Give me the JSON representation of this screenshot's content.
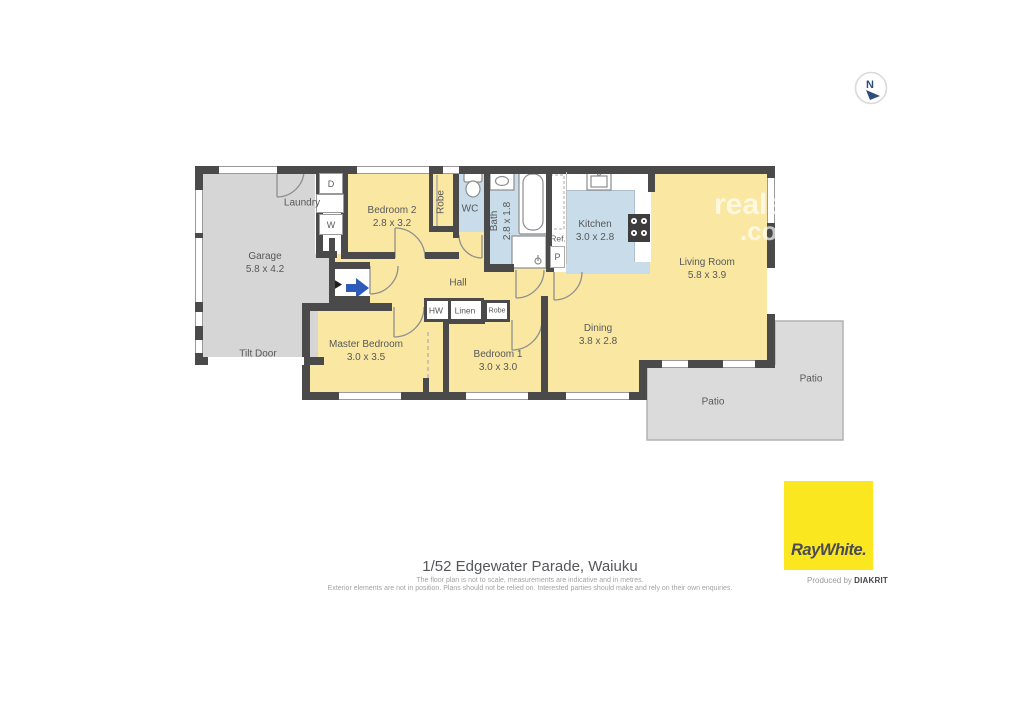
{
  "address": "1/52 Edgewater Parade, Waiuku",
  "disclaimer_line1": "The floor plan is not to scale, measurements are indicative and in metres.",
  "disclaimer_line2": "Exterior elements are not in position. Plans should not be relied on. Interested parties should make and rely on their own enquiries.",
  "compass": {
    "north_label": "N"
  },
  "watermark": {
    "line1": "realestate",
    "line2": ".com.au"
  },
  "branding": {
    "logo_text": "RayWhite.",
    "produced_by_prefix": "Produced by",
    "producer": "DIAKRIT",
    "logo_color": "#FBE71F"
  },
  "colors": {
    "room_yellow": "#FAE8A2",
    "wet_area_blue": "#C9DCE9",
    "garage_gray": "#D6D6D6",
    "patio_gray": "#DBDBDB",
    "wall": "#4A4A4A",
    "entry_arrow_blue": "#2E5BBA"
  },
  "rooms": {
    "garage": {
      "name": "Garage",
      "dims": "5.8 x 4.2"
    },
    "laundry": {
      "name": "Laundry"
    },
    "bedroom2": {
      "name": "Bedroom 2",
      "dims": "2.8 x 3.2"
    },
    "robe_bed2": {
      "name": "Robe"
    },
    "wc": {
      "name": "WC"
    },
    "bath": {
      "name": "Bath",
      "dims": "2.8 x 1.8"
    },
    "kitchen": {
      "name": "Kitchen",
      "dims": "3.0 x 2.8"
    },
    "living": {
      "name": "Living Room",
      "dims": "5.8 x 3.9"
    },
    "hall": {
      "name": "Hall"
    },
    "hw": {
      "name": "HW"
    },
    "linen": {
      "name": "Linen"
    },
    "robe_bed1": {
      "name": "Robe"
    },
    "master": {
      "name": "Master Bedroom",
      "dims": "3.0 x 3.5"
    },
    "bedroom1": {
      "name": "Bedroom 1",
      "dims": "3.0 x 3.0"
    },
    "dining": {
      "name": "Dining",
      "dims": "3.8 x 2.8"
    },
    "patio_lower": {
      "name": "Patio"
    },
    "patio_right": {
      "name": "Patio"
    }
  },
  "fixtures": {
    "dryer": "D",
    "washer": "W",
    "fridge": "Ref.",
    "pantry": "P"
  },
  "annotations": {
    "tilt_door": "Tilt Door"
  }
}
